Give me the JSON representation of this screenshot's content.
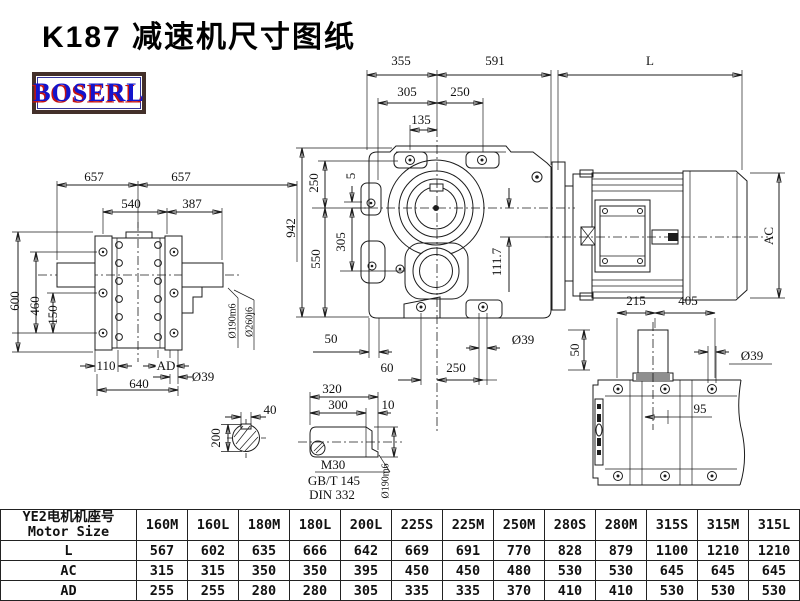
{
  "page": {
    "title": "K187 减速机尺寸图纸",
    "logo": "BOSERL"
  },
  "drawing": {
    "dims": {
      "d355": "355",
      "d591": "591",
      "dL": "L",
      "d305t": "305",
      "d250t": "250",
      "d135": "135",
      "d942": "942",
      "d250l": "250",
      "d5": "5",
      "d305l": "305",
      "d550": "550",
      "d1117": "111.7",
      "d50bl": "50",
      "d60": "60",
      "d250b": "250",
      "d39m": "Ø39",
      "d50r": "50",
      "d657a": "657",
      "d657b": "657",
      "d540": "540",
      "d387": "387",
      "d600": "600",
      "d460": "460",
      "d150": "150",
      "d190a": "Ø190m6",
      "d260": "Ø260j6",
      "d110": "110",
      "dAD": "AD",
      "d640": "640",
      "d39l": "Ø39",
      "dAC": "AC",
      "d215": "215",
      "d405": "405",
      "d39br": "Ø39",
      "d95": "95",
      "d40": "40",
      "d200": "200",
      "d320": "320",
      "d300": "300",
      "d10": "10",
      "m30": "M30",
      "gbt": "GB/T 145",
      "din": "DIN 332",
      "d190b": "Ø190m6"
    }
  },
  "table": {
    "header_line1": "YE2电机机座号",
    "header_line2": "Motor Size",
    "columns": [
      "160M",
      "160L",
      "180M",
      "180L",
      "200L",
      "225S",
      "225M",
      "250M",
      "280S",
      "280M",
      "315S",
      "315M",
      "315L"
    ],
    "rows": [
      {
        "label": "L",
        "values": [
          "567",
          "602",
          "635",
          "666",
          "642",
          "669",
          "691",
          "770",
          "828",
          "879",
          "1100",
          "1210",
          "1210"
        ]
      },
      {
        "label": "AC",
        "values": [
          "315",
          "315",
          "350",
          "350",
          "395",
          "450",
          "450",
          "480",
          "530",
          "530",
          "645",
          "645",
          "645"
        ]
      },
      {
        "label": "AD",
        "values": [
          "255",
          "255",
          "280",
          "280",
          "305",
          "335",
          "335",
          "370",
          "410",
          "410",
          "530",
          "530",
          "530"
        ]
      }
    ]
  }
}
